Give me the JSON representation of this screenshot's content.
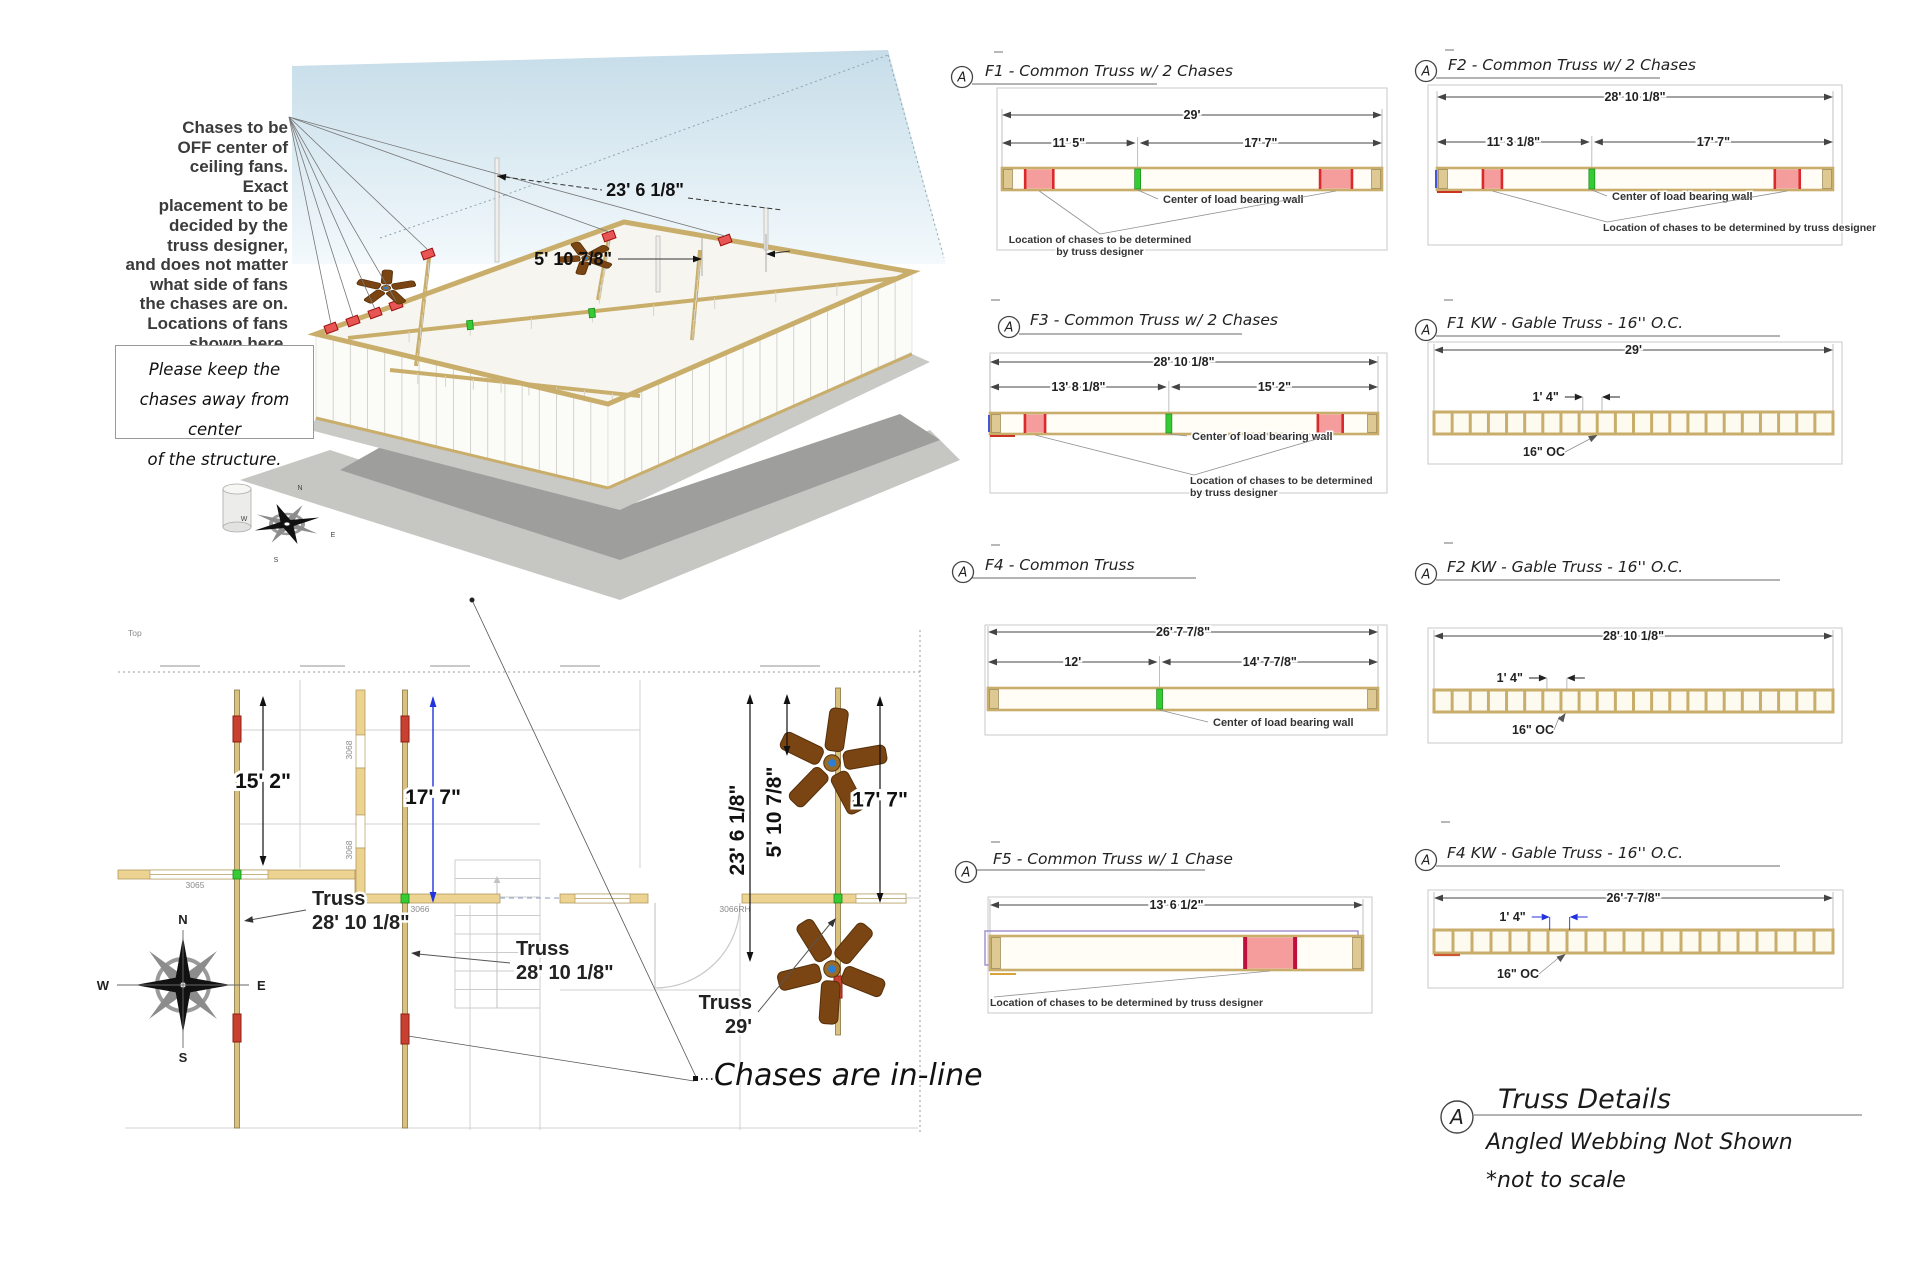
{
  "canvas": {
    "w": 1920,
    "h": 1280
  },
  "colors": {
    "tan": "#c9ae6b",
    "tan_dark": "#8a7544",
    "bar_fill": "#fffdf5",
    "cap_fill": "#ddc991",
    "red_edge": "#d92b2b",
    "red_fill": "#f59c9c",
    "crimson": "#c00f3c",
    "chase_plan": "#c8402f",
    "green": "#35cb35",
    "blue": "#2233dd",
    "purple": "#9c8ccc",
    "dim_line": "#444444",
    "witness": "#b0b0b0",
    "leader": "#909090",
    "box_border": "#c8c8c8",
    "sky": "#c6dde9",
    "shadow": "#9e9e9c",
    "fan": "#7a4413",
    "wall_tan": "#ecd391"
  },
  "view3d": {
    "note_lines": [
      "Chases to be",
      "OFF center of",
      "ceiling fans.",
      "Exact",
      "placement to be",
      "decided by the",
      "truss designer,",
      "and does not matter",
      "what side of fans",
      "the chases are on.",
      "Locations of fans",
      "shown here."
    ],
    "keep_note_lines": [
      "Please keep the",
      "chases away from center",
      "of the structure."
    ],
    "dim_a": "23' 6 1/8\"",
    "dim_b": "5' 10 7/8\""
  },
  "floorplan": {
    "corner_label": "Top",
    "dim_left": "15' 2\"",
    "dim_blue": "17' 7\"",
    "dim_rot_a": "23' 6 1/8\"",
    "dim_rot_b": "5' 10 7/8\"",
    "dim_right": "17' 7\"",
    "truss_labels": [
      [
        "Truss",
        "28' 10 1/8\""
      ],
      [
        "Truss",
        "28' 10 1/8\""
      ],
      [
        "Truss",
        "29'"
      ]
    ],
    "chases_note": "Chases are in-line",
    "compass": {
      "n": "N",
      "e": "E",
      "s": "S",
      "w": "W"
    },
    "door_labels": {
      "d3065": "3065",
      "d3066": "3066",
      "d3066rh": "3066RH",
      "d3068a": "3068",
      "d3068b": "3068"
    }
  },
  "diagrams": [
    {
      "id": "F1",
      "marker": "A",
      "title": "F1 - Common Truss w/ 2 Chases",
      "type": "common",
      "box": [
        997,
        88,
        390,
        162
      ],
      "bar_x1": 1002,
      "bar_x2": 1382,
      "bar_y": 168,
      "bar_h": 22,
      "title_pos": [
        985,
        76
      ],
      "marker_pos": [
        962,
        77
      ],
      "underline": [
        972,
        1157,
        84
      ],
      "tick": [
        994,
        52
      ],
      "dim_total": {
        "label": "29'",
        "y": 115
      },
      "dim_split": {
        "y": 143,
        "frac": 0.357,
        "left": "11' 5\"",
        "right": "17' 7\""
      },
      "chases": [
        [
          0.061,
          0.074
        ],
        [
          0.837,
          0.084
        ]
      ],
      "center_frac": 0.357,
      "center_label": {
        "text": "Center of load bearing wall",
        "x": 1163,
        "y": 203,
        "anchor": "start"
      },
      "chase_label": {
        "lines": [
          "Location of chases to be determined",
          "by truss designer"
        ],
        "x": 1100,
        "y": 243,
        "anchor": "middle"
      }
    },
    {
      "id": "F2",
      "marker": "A",
      "title": "F2 - Common Truss w/ 2 Chases",
      "type": "common",
      "box": [
        1428,
        85,
        414,
        160
      ],
      "bar_x1": 1437,
      "bar_x2": 1833,
      "bar_y": 168,
      "bar_h": 22,
      "title_pos": [
        1448,
        70
      ],
      "marker_pos": [
        1426,
        71
      ],
      "underline": [
        1436,
        1660,
        78
      ],
      "tick": [
        1445,
        50
      ],
      "dim_total": {
        "label": "28' 10 1/8\"",
        "y": 97
      },
      "dim_split": {
        "y": 142,
        "frac": 0.391,
        "left": "11' 3 1/8\"",
        "right": "17' 7\""
      },
      "chases": [
        [
          0.116,
          0.048
        ],
        [
          0.853,
          0.063
        ]
      ],
      "center_frac": 0.391,
      "blue_tick": true,
      "red_underline": true,
      "center_label": {
        "text": "Center of load bearing wall",
        "x": 1612,
        "y": 200,
        "anchor": "start"
      },
      "chase_label": {
        "lines": [
          "Location of chases to be determined by truss designer"
        ],
        "x": 1603,
        "y": 231,
        "anchor": "start"
      }
    },
    {
      "id": "F3",
      "marker": "A",
      "title": "F3 - Common Truss w/ 2 Chases",
      "type": "common",
      "box": [
        990,
        353,
        397,
        140
      ],
      "bar_x1": 990,
      "bar_x2": 1378,
      "bar_y": 413,
      "bar_h": 21,
      "title_pos": [
        1030,
        325
      ],
      "marker_pos": [
        1009,
        327
      ],
      "underline": [
        1019,
        1242,
        334
      ],
      "tick": [
        991,
        300
      ],
      "dim_total": {
        "label": "28' 10 1/8\"",
        "y": 362
      },
      "dim_split": {
        "y": 387,
        "frac": 0.461,
        "left": "13' 8 1/8\"",
        "right": "15' 2\""
      },
      "chases": [
        [
          0.09,
          0.052
        ],
        [
          0.845,
          0.064
        ]
      ],
      "center_frac": 0.461,
      "blue_tick": true,
      "red_underline": true,
      "center_label": {
        "text": "Center of load bearing wall",
        "x": 1192,
        "y": 440,
        "anchor": "start"
      },
      "chase_label": {
        "lines": [
          "Location of chases to be determined",
          "by truss designer"
        ],
        "x": 1190,
        "y": 484,
        "anchor": "start"
      }
    },
    {
      "id": "F1KW",
      "marker": "A",
      "title": "F1 KW - Gable Truss - 16'' O.C.",
      "type": "gable",
      "box": [
        1428,
        342,
        414,
        122
      ],
      "bar_x1": 1434,
      "bar_x2": 1833,
      "bar_y": 412,
      "bar_h": 22,
      "studs": 21,
      "title_pos": [
        1447,
        328
      ],
      "marker_pos": [
        1426,
        330
      ],
      "underline": [
        1436,
        1780,
        336
      ],
      "tick": [
        1444,
        300
      ],
      "dim_total": {
        "label": "29'",
        "y": 350
      },
      "dim_oc": {
        "label": "1' 4\"",
        "y": 397,
        "frac1": 0.373,
        "frac2": 0.421,
        "blue": false
      },
      "oc_label": {
        "text": "16\" OC",
        "x": 1523,
        "y": 456,
        "tip_frac": 0.41
      }
    },
    {
      "id": "F4",
      "marker": "A",
      "title": "F4 - Common Truss",
      "type": "common",
      "box": [
        985,
        625,
        402,
        110
      ],
      "bar_x1": 988,
      "bar_x2": 1378,
      "bar_y": 688,
      "bar_h": 22,
      "title_pos": [
        985,
        570
      ],
      "marker_pos": [
        963,
        572
      ],
      "underline": [
        972,
        1196,
        578
      ],
      "tick": [
        991,
        545
      ],
      "dim_total": {
        "label": "26' 7 7/8\"",
        "y": 632
      },
      "dim_split": {
        "y": 662,
        "frac": 0.44,
        "left": "12'",
        "right": "14' 7 7/8\""
      },
      "chases": [],
      "center_frac": 0.44,
      "center_label": {
        "text": "Center of load bearing wall",
        "x": 1213,
        "y": 726,
        "anchor": "start"
      }
    },
    {
      "id": "F2KW",
      "marker": "A",
      "title": "F2 KW - Gable Truss - 16'' O.C.",
      "type": "gable",
      "box": [
        1428,
        628,
        414,
        115
      ],
      "bar_x1": 1434,
      "bar_x2": 1833,
      "bar_y": 690,
      "bar_h": 22,
      "studs": 21,
      "title_pos": [
        1447,
        572
      ],
      "marker_pos": [
        1426,
        574
      ],
      "underline": [
        1436,
        1780,
        580
      ],
      "tick": [
        1444,
        543
      ],
      "dim_total": {
        "label": "28' 10 1/8\"",
        "y": 636
      },
      "dim_oc": {
        "label": "1' 4\"",
        "y": 678,
        "frac1": 0.283,
        "frac2": 0.333,
        "blue": false
      },
      "oc_label": {
        "text": "16\" OC",
        "x": 1512,
        "y": 734,
        "tip_frac": 0.33
      }
    },
    {
      "id": "F5",
      "marker": "A",
      "title": "F5 - Common Truss w/ 1 Chase",
      "type": "common",
      "box": [
        988,
        897,
        384,
        116
      ],
      "bar_x1": 990,
      "bar_x2": 1363,
      "bar_y": 936,
      "bar_h": 34,
      "title_pos": [
        993,
        864
      ],
      "marker_pos": [
        966,
        872
      ],
      "underline": [
        975,
        1205,
        870
      ],
      "tick": [
        991,
        842
      ],
      "dim_total": {
        "label": "13' 6 1/2\"",
        "y": 905
      },
      "chases": [
        [
          0.684,
          0.134
        ]
      ],
      "chase_heavy": true,
      "outline2": true,
      "chase_label": {
        "lines": [
          "Location of chases to be determined by truss designer"
        ],
        "x": 990,
        "y": 1006,
        "anchor": "start"
      }
    },
    {
      "id": "F4KW",
      "marker": "A",
      "title": "F4 KW - Gable Truss - 16'' O.C.",
      "type": "gable",
      "box": [
        1428,
        890,
        415,
        98
      ],
      "bar_x1": 1434,
      "bar_x2": 1833,
      "bar_y": 930,
      "bar_h": 23,
      "studs": 20,
      "title_pos": [
        1447,
        858
      ],
      "marker_pos": [
        1426,
        860
      ],
      "underline": [
        1436,
        1780,
        866
      ],
      "tick": [
        1441,
        822
      ],
      "dim_total": {
        "label": "26' 7 7/8\"",
        "y": 898
      },
      "dim_oc": {
        "label": "1' 4\"",
        "y": 917,
        "frac1": 0.29,
        "frac2": 0.34,
        "blue": true
      },
      "oc_label": {
        "text": "16\" OC",
        "x": 1497,
        "y": 978,
        "tip_frac": 0.33
      },
      "red_underline": true
    }
  ],
  "titleblock": {
    "marker": "A",
    "title": "Truss Details",
    "sub1": "Angled Webbing Not Shown",
    "sub2": "*not to scale"
  }
}
